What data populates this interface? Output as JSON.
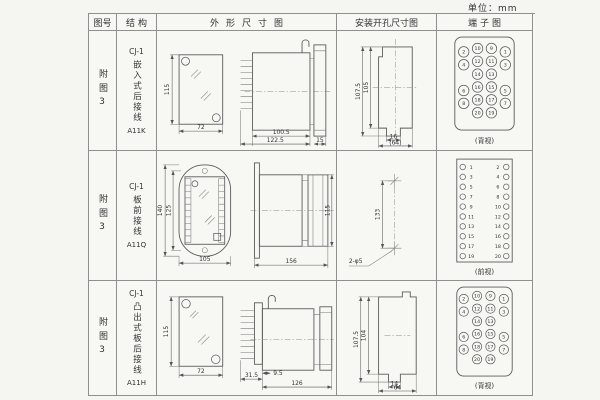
{
  "unit_label": "单位：mm",
  "table": {
    "headers": [
      "图号",
      "结构",
      "外形尺寸图",
      "安装开孔尺寸图",
      "端子图"
    ]
  },
  "rows": [
    {
      "fig_label": "附图3",
      "structure": {
        "model": "CJ-1",
        "name": "嵌入式后接线",
        "code": "A11K"
      },
      "outline": {
        "height": "115",
        "width": "72",
        "body_len": "100.5",
        "total_len": "122.5",
        "rear_len": "15"
      },
      "mount": {
        "outer_h": "107.5",
        "inner_h": "105",
        "notch_w": "16",
        "overall_w": "(64)"
      },
      "terminal": {
        "view_label": "(背视)",
        "pins": [
          "2",
          "10",
          "9",
          "1",
          "4",
          "12",
          "11",
          "3",
          "14",
          "13",
          "6",
          "16",
          "15",
          "5",
          "8",
          "18",
          "17",
          "7",
          "20",
          "19"
        ]
      }
    },
    {
      "fig_label": "附图3",
      "structure": {
        "model": "CJ-1",
        "name": "板前接线",
        "code": "A11Q"
      },
      "outline": {
        "height": "140",
        "inner_height": "125",
        "width": "105",
        "side_len": "156",
        "side_h": "115"
      },
      "mount": {
        "hole_dist": "133",
        "holes": "2-φ5"
      },
      "terminal": {
        "view_label": "(前视)",
        "left": [
          "1",
          "3",
          "5",
          "7",
          "9",
          "11",
          "13",
          "15",
          "17",
          "19"
        ],
        "right": [
          "2",
          "4",
          "6",
          "8",
          "10",
          "12",
          "14",
          "16",
          "18",
          "20"
        ]
      }
    },
    {
      "fig_label": "附图3",
      "structure": {
        "model": "CJ-1",
        "name": "凸出式板后接线",
        "code": "A11H"
      },
      "outline": {
        "height": "115",
        "width": "72",
        "offset1": "31.5",
        "offset2": "9.5",
        "total_len": "126"
      },
      "mount": {
        "outer_h": "107.5",
        "inner_h": "104",
        "notch_w": "14",
        "overall_w": "64"
      },
      "terminal": {
        "view_label": "(背视)",
        "pins": [
          "2",
          "10",
          "9",
          "1",
          "4",
          "12",
          "11",
          "3",
          "14",
          "13",
          "6",
          "16",
          "15",
          "5",
          "8",
          "18",
          "17",
          "7",
          "20",
          "19"
        ]
      }
    }
  ]
}
